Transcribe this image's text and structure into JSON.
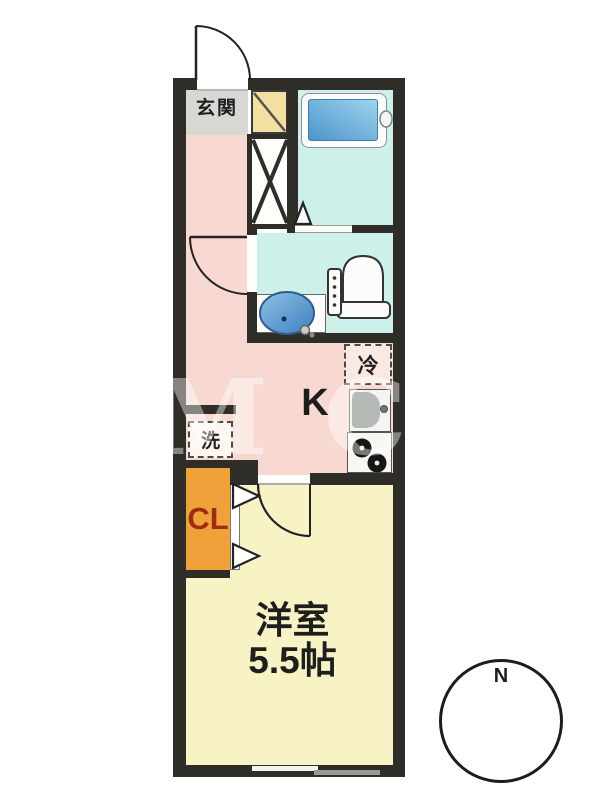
{
  "title": "Japanese apartment floor plan (1K)",
  "watermark": "OM C",
  "compass": {
    "north_label": "N"
  },
  "rooms": {
    "genkan": {
      "label": "玄関"
    },
    "kitchen": {
      "label": "K"
    },
    "refrigerator": {
      "label": "冷"
    },
    "washer": {
      "label": "洗"
    },
    "closet": {
      "label": "CL"
    },
    "western_room": {
      "name": "洋室",
      "size": "5.5帖"
    }
  },
  "fixtures": [
    "entrance-door",
    "shoe-cabinet",
    "pipe-space",
    "bathtub",
    "bath-door",
    "wash-basin",
    "toilet",
    "interior-door",
    "refrigerator-space",
    "kitchen-sink",
    "gas-stove",
    "washing-machine-space",
    "closet-folding-doors",
    "room-door",
    "sliding-window",
    "compass"
  ],
  "colors": {
    "wall": "#2e2d28",
    "genkan_floor": "#d8d7d3",
    "hall_kitchen_floor": "#f7d9d2",
    "bathroom_floor": "#cdf1ea",
    "western_room_floor": "#f7f3c5",
    "closet": "#efa239",
    "closet_text": "#9e2c15",
    "bathtub_water": "#4d94cc",
    "shoe_cabinet": "#f3dfa2",
    "refrigerator_fill": "#fae8e2"
  }
}
